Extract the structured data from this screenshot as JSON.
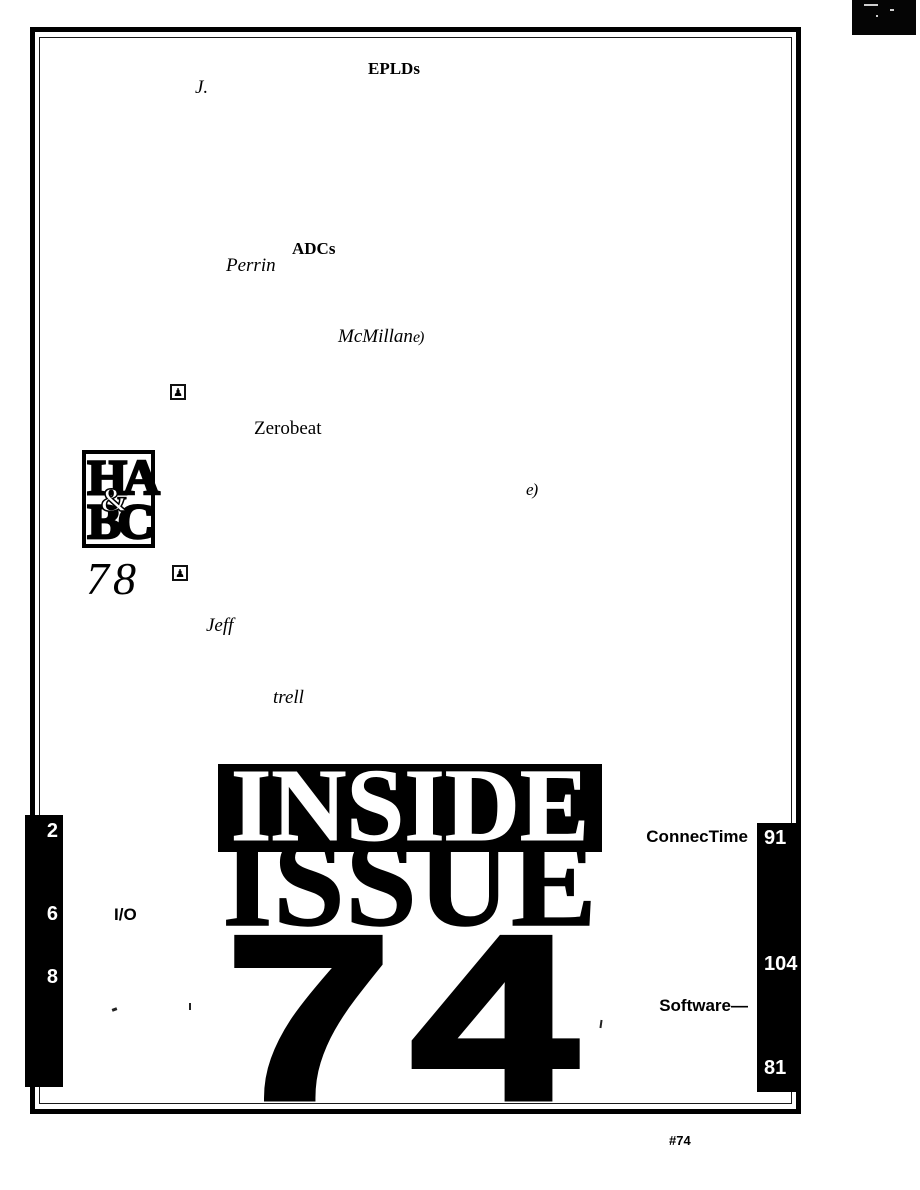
{
  "colors": {
    "ink": "#000000",
    "paper": "#ffffff"
  },
  "icons": {
    "article_end_mark": "e)",
    "pawn_marker": "♟"
  },
  "toc": {
    "eplds_label": "EPLDs",
    "author_j": "J.",
    "adcs_label": "ADCs",
    "author_perrin": "Perrin",
    "author_mcmillan": "McMillan",
    "zerobeat_label": "Zerobeat",
    "author_jeff": "Jeff",
    "author_trell": "trell",
    "page_78": "78"
  },
  "logo": {
    "top": "HA",
    "amp": "&",
    "bottom": "BC"
  },
  "title": {
    "line1": "INSIDE",
    "line2": "ISSUE",
    "number": "74"
  },
  "left_rail": {
    "pages": [
      "2",
      "6",
      "8"
    ],
    "io_label": "I/O"
  },
  "right_rail": {
    "connectime_label": "ConnecTime",
    "connectime_page": "91",
    "page_104": "104",
    "software_label": "Software—",
    "page_81": "81"
  },
  "footer": {
    "issue_tag": "#74"
  }
}
